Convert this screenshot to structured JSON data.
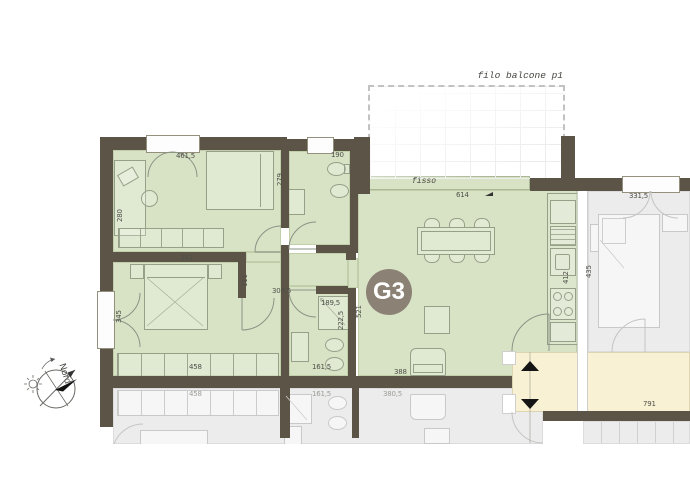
{
  "unit": {
    "badge": "G3"
  },
  "annotations": {
    "balcony": "filo balcone p1",
    "fixed_glazing": "fisso",
    "compass": "Nord"
  },
  "dims": {
    "room1_width": "461,5",
    "room1_depth": "280",
    "bath1_width": "190",
    "bath1_depth": "279",
    "bedroom_wall": "341",
    "hall_wall": "111",
    "bedroom_window": "345",
    "hallway_width": "307,5",
    "shower_width": "189,5",
    "bath2_depth": "222,5",
    "living_depth": "521",
    "wardrobe": "458",
    "bath2_width": "161,5",
    "living_width": "388",
    "glazing_width": "614",
    "kitchen_depth": "412",
    "neighbor_bed_depth": "435",
    "neighbor_window": "331,5",
    "corridor_length": "791",
    "lower_wardrobe": "458",
    "lower_bath_width": "161,5",
    "lower_living_width": "380,5"
  },
  "colors": {
    "wall": "#5c5447",
    "room": "#d8e3c6",
    "corridor": "#f8f1d3",
    "neighbor": "#ececec",
    "badge": "#8b8174"
  }
}
